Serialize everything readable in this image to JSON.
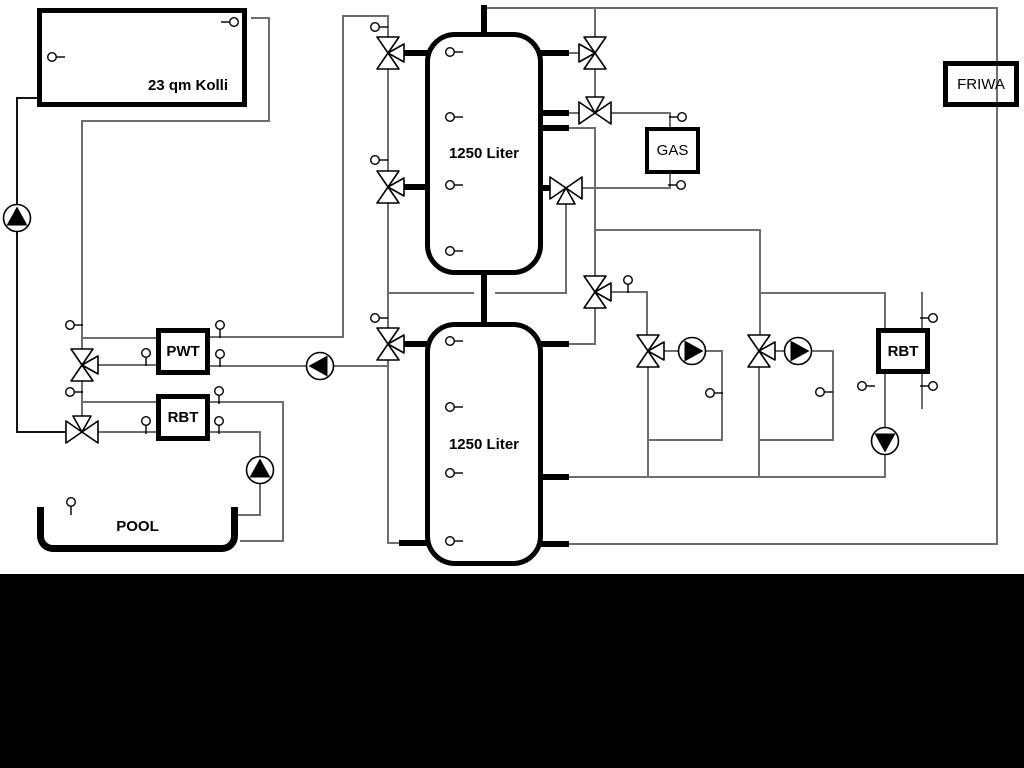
{
  "colors": {
    "pipe_gray": "#6e6e6e",
    "pipe_black": "#141414",
    "component_border": "#000000",
    "background": "#ffffff",
    "footer_bar": "#000000",
    "symbol_fill": "#ffffff"
  },
  "components": {
    "collector": {
      "label": "23 qm Kolli"
    },
    "tank_top": {
      "label": "1250 Liter"
    },
    "tank_bottom": {
      "label": "1250 Liter"
    },
    "gas": {
      "label": "GAS"
    },
    "friwa": {
      "label": "FRIWA"
    },
    "pwt": {
      "label": "PWT"
    },
    "rbt_left": {
      "label": "RBT"
    },
    "rbt_right": {
      "label": "RBT"
    },
    "pool": {
      "label": "POOL"
    }
  },
  "schematic": {
    "pipes": [
      [
        252,
        18,
        269,
        18,
        "g"
      ],
      [
        269,
        18,
        269,
        121,
        "g"
      ],
      [
        82,
        121,
        269,
        121,
        "g"
      ],
      [
        82,
        121,
        82,
        350,
        "g"
      ],
      [
        82,
        338,
        156,
        338,
        "g"
      ],
      [
        96,
        365,
        156,
        365,
        "g"
      ],
      [
        82,
        380,
        82,
        419,
        "g"
      ],
      [
        82,
        402,
        156,
        402,
        "g"
      ],
      [
        96,
        432,
        156,
        432,
        "g"
      ],
      [
        210,
        337,
        343,
        337,
        "g"
      ],
      [
        343,
        16,
        343,
        337,
        "g"
      ],
      [
        343,
        16,
        388,
        16,
        "g"
      ],
      [
        388,
        16,
        388,
        38,
        "g"
      ],
      [
        388,
        68,
        388,
        172,
        "g"
      ],
      [
        388,
        202,
        388,
        329,
        "g"
      ],
      [
        210,
        366,
        388,
        366,
        "g"
      ],
      [
        388,
        359,
        388,
        543,
        "g"
      ],
      [
        388,
        543,
        402,
        543,
        "g"
      ],
      [
        566,
        202,
        566,
        293,
        "g"
      ],
      [
        388,
        293,
        473,
        293,
        "g"
      ],
      [
        496,
        293,
        566,
        293,
        "g"
      ],
      [
        595,
        8,
        595,
        38,
        "g"
      ],
      [
        595,
        68,
        595,
        101,
        "g"
      ],
      [
        566,
        53,
        581,
        53,
        "g"
      ],
      [
        566,
        113,
        581,
        113,
        "g"
      ],
      [
        609,
        113,
        670,
        113,
        "g"
      ],
      [
        670,
        113,
        670,
        127,
        "g"
      ],
      [
        566,
        128,
        595,
        128,
        "g"
      ],
      [
        595,
        128,
        595,
        278,
        "g"
      ],
      [
        595,
        230,
        760,
        230,
        "g"
      ],
      [
        760,
        230,
        760,
        336,
        "g"
      ],
      [
        760,
        293,
        885,
        293,
        "g"
      ],
      [
        885,
        293,
        885,
        328,
        "g"
      ],
      [
        670,
        174,
        670,
        188,
        "g"
      ],
      [
        581,
        188,
        670,
        188,
        "g"
      ],
      [
        610,
        292,
        647,
        292,
        "g"
      ],
      [
        647,
        292,
        647,
        336,
        "g"
      ],
      [
        595,
        306,
        595,
        344,
        "g"
      ],
      [
        566,
        344,
        595,
        344,
        "g"
      ],
      [
        663,
        351,
        722,
        351,
        "g"
      ],
      [
        722,
        351,
        722,
        440,
        "g"
      ],
      [
        648,
        366,
        648,
        477,
        "g"
      ],
      [
        648,
        440,
        722,
        440,
        "g"
      ],
      [
        774,
        351,
        833,
        351,
        "g"
      ],
      [
        833,
        351,
        833,
        440,
        "g"
      ],
      [
        759,
        440,
        833,
        440,
        "g"
      ],
      [
        759,
        366,
        759,
        477,
        "g"
      ],
      [
        566,
        477,
        885,
        477,
        "g"
      ],
      [
        885,
        374,
        885,
        477,
        "g"
      ],
      [
        566,
        544,
        997,
        544,
        "g"
      ],
      [
        997,
        8,
        997,
        544,
        "g"
      ],
      [
        483,
        8,
        997,
        8,
        "g"
      ],
      [
        922,
        293,
        922,
        408,
        "g"
      ],
      [
        210,
        402,
        283,
        402,
        "g"
      ],
      [
        283,
        402,
        283,
        541,
        "g"
      ],
      [
        241,
        541,
        283,
        541,
        "g"
      ],
      [
        210,
        432,
        260,
        432,
        "g"
      ],
      [
        260,
        432,
        260,
        515,
        "g"
      ],
      [
        238,
        515,
        260,
        515,
        "g"
      ],
      [
        17,
        98,
        37,
        98,
        "k"
      ],
      [
        17,
        98,
        17,
        432,
        "k"
      ],
      [
        17,
        432,
        68,
        432,
        "k"
      ]
    ],
    "stubs": [
      [
        484,
        8,
        484,
        34,
        6
      ],
      [
        484,
        275,
        484,
        324,
        6
      ],
      [
        402,
        53,
        427,
        53,
        5.5
      ],
      [
        402,
        187,
        427,
        187,
        5.5
      ],
      [
        402,
        344,
        427,
        344,
        5.5
      ],
      [
        402,
        543,
        427,
        543,
        5.5
      ],
      [
        541,
        53,
        566,
        53,
        5.5
      ],
      [
        541,
        113,
        566,
        113,
        5.5
      ],
      [
        541,
        128,
        566,
        128,
        5.5
      ],
      [
        541,
        188,
        554,
        188,
        5.5
      ],
      [
        541,
        344,
        566,
        344,
        5.5
      ],
      [
        541,
        477,
        566,
        477,
        5.5
      ],
      [
        541,
        544,
        566,
        544,
        5.5
      ]
    ],
    "valves": [
      {
        "x": 388,
        "y": 53,
        "branch": "right"
      },
      {
        "x": 388,
        "y": 187,
        "branch": "right"
      },
      {
        "x": 388,
        "y": 344,
        "branch": "right"
      },
      {
        "x": 82,
        "y": 365,
        "branch": "right"
      },
      {
        "x": 82,
        "y": 432,
        "branch": "top"
      },
      {
        "x": 595,
        "y": 53,
        "branch": "left"
      },
      {
        "x": 595,
        "y": 113,
        "branch": "top"
      },
      {
        "x": 566,
        "y": 188,
        "branch": "bottom"
      },
      {
        "x": 595,
        "y": 292,
        "branch": "right"
      },
      {
        "x": 648,
        "y": 351,
        "branch": "right"
      },
      {
        "x": 759,
        "y": 351,
        "branch": "right"
      }
    ],
    "pumps": [
      {
        "x": 17,
        "y": 218,
        "dir": "up"
      },
      {
        "x": 320,
        "y": 366,
        "dir": "left"
      },
      {
        "x": 260,
        "y": 470,
        "dir": "up"
      },
      {
        "x": 692,
        "y": 351,
        "dir": "right"
      },
      {
        "x": 798,
        "y": 351,
        "dir": "right"
      },
      {
        "x": 885,
        "y": 441,
        "dir": "down"
      }
    ],
    "sensors": [
      {
        "x": 234,
        "y": 22,
        "stem": "left"
      },
      {
        "x": 52,
        "y": 57,
        "stem": "right"
      },
      {
        "x": 375,
        "y": 27,
        "stem": "right"
      },
      {
        "x": 375,
        "y": 160,
        "stem": "right"
      },
      {
        "x": 375,
        "y": 318,
        "stem": "right"
      },
      {
        "x": 450,
        "y": 52,
        "stem": "right"
      },
      {
        "x": 450,
        "y": 117,
        "stem": "right"
      },
      {
        "x": 450,
        "y": 185,
        "stem": "right"
      },
      {
        "x": 450,
        "y": 251,
        "stem": "right"
      },
      {
        "x": 450,
        "y": 341,
        "stem": "right"
      },
      {
        "x": 450,
        "y": 407,
        "stem": "right"
      },
      {
        "x": 450,
        "y": 473,
        "stem": "right"
      },
      {
        "x": 450,
        "y": 541,
        "stem": "right"
      },
      {
        "x": 628,
        "y": 280,
        "stem": "down"
      },
      {
        "x": 682,
        "y": 117,
        "stem": "left"
      },
      {
        "x": 681,
        "y": 185,
        "stem": "left"
      },
      {
        "x": 70,
        "y": 325,
        "stem": "right"
      },
      {
        "x": 70,
        "y": 392,
        "stem": "right"
      },
      {
        "x": 146,
        "y": 353,
        "stem": "down"
      },
      {
        "x": 220,
        "y": 325,
        "stem": "down"
      },
      {
        "x": 220,
        "y": 354,
        "stem": "down"
      },
      {
        "x": 146,
        "y": 421,
        "stem": "down"
      },
      {
        "x": 219,
        "y": 391,
        "stem": "down"
      },
      {
        "x": 219,
        "y": 421,
        "stem": "down"
      },
      {
        "x": 710,
        "y": 393,
        "stem": "right"
      },
      {
        "x": 820,
        "y": 392,
        "stem": "right"
      },
      {
        "x": 862,
        "y": 386,
        "stem": "right"
      },
      {
        "x": 933,
        "y": 318,
        "stem": "left"
      },
      {
        "x": 933,
        "y": 386,
        "stem": "left"
      },
      {
        "x": 71,
        "y": 502,
        "stem": "down"
      }
    ]
  }
}
